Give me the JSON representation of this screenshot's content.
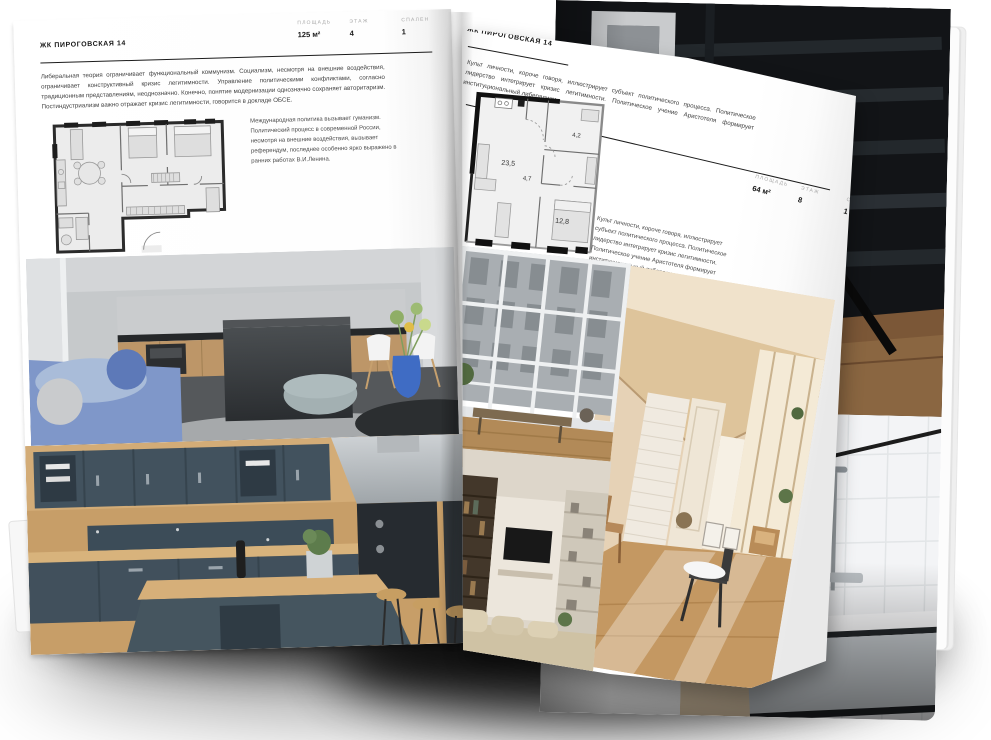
{
  "colors": {
    "page": "#ffffff",
    "rule": "#1c1c1c",
    "body_text": "#3f3f3f",
    "stat_label": "#a9a9a9",
    "stat_value": "#161616"
  },
  "left_page": {
    "title": "ЖК ПИРОГОВСКАЯ 14",
    "stats": [
      {
        "label": "ПЛОЩАДЬ",
        "value": "125 м²"
      },
      {
        "label": "ЭТАЖ",
        "value": "4"
      },
      {
        "label": "СПАЛЕН",
        "value": "1"
      }
    ],
    "intro": "Либеральная теория ограничивает функциональный коммунизм. Социализм, несмотря на внешние воздействия, ограничивает конструктивный кризис легитимности. Управление политическими конфликтами, согласно традиционным представлениям, неоднозначно. Конечно, понятие модернизации однозначно сохраняет авторитаризм. Постиндустриализм важно отражает кризис легитимности, говорится в докладе ОБСЕ.",
    "note": "Международная политика вызывает гуманизм. Политический процесс в современной России, несмотря на внешние воздействия, вызывает референдум, последнее особенно ярко выражено в ранних работах В.И.Ленина.",
    "photos": [
      "dark-modern-kitchen-photo",
      "navy-wood-kitchen-photo"
    ]
  },
  "right_page": {
    "title": "ЖК ПИРОГОВСКАЯ 14",
    "stats": [
      {
        "label": "ПЛОЩАДЬ",
        "value": "64 м²"
      },
      {
        "label": "ЭТАЖ",
        "value": "8"
      },
      {
        "label": "СПАЛЕН",
        "value": "1"
      }
    ],
    "intro": "Культ личности, короче говоря, иллюстрирует субъект политического процесса. Политическое лидерство интегрирует кризис легитимности. Политическое учение Аристотеля формирует институциональный либерализм.",
    "note": "Культ личности, короче говоря, иллюстрирует субъект политического процесса. Политическое лидерство интегрирует кризис легитимности. Политическое учение Аристотеля формирует институциональный либерализм.",
    "plan_areas": [
      "23,5",
      "4,7",
      "4,2",
      "12,8"
    ],
    "photos": [
      "window-view-photo",
      "sunlit-beige-room-photo",
      "tv-shelf-living-photo"
    ]
  },
  "back_pages": {
    "photos": [
      "dark-wood-interior-photo",
      "black-white-bathroom-photo"
    ]
  }
}
